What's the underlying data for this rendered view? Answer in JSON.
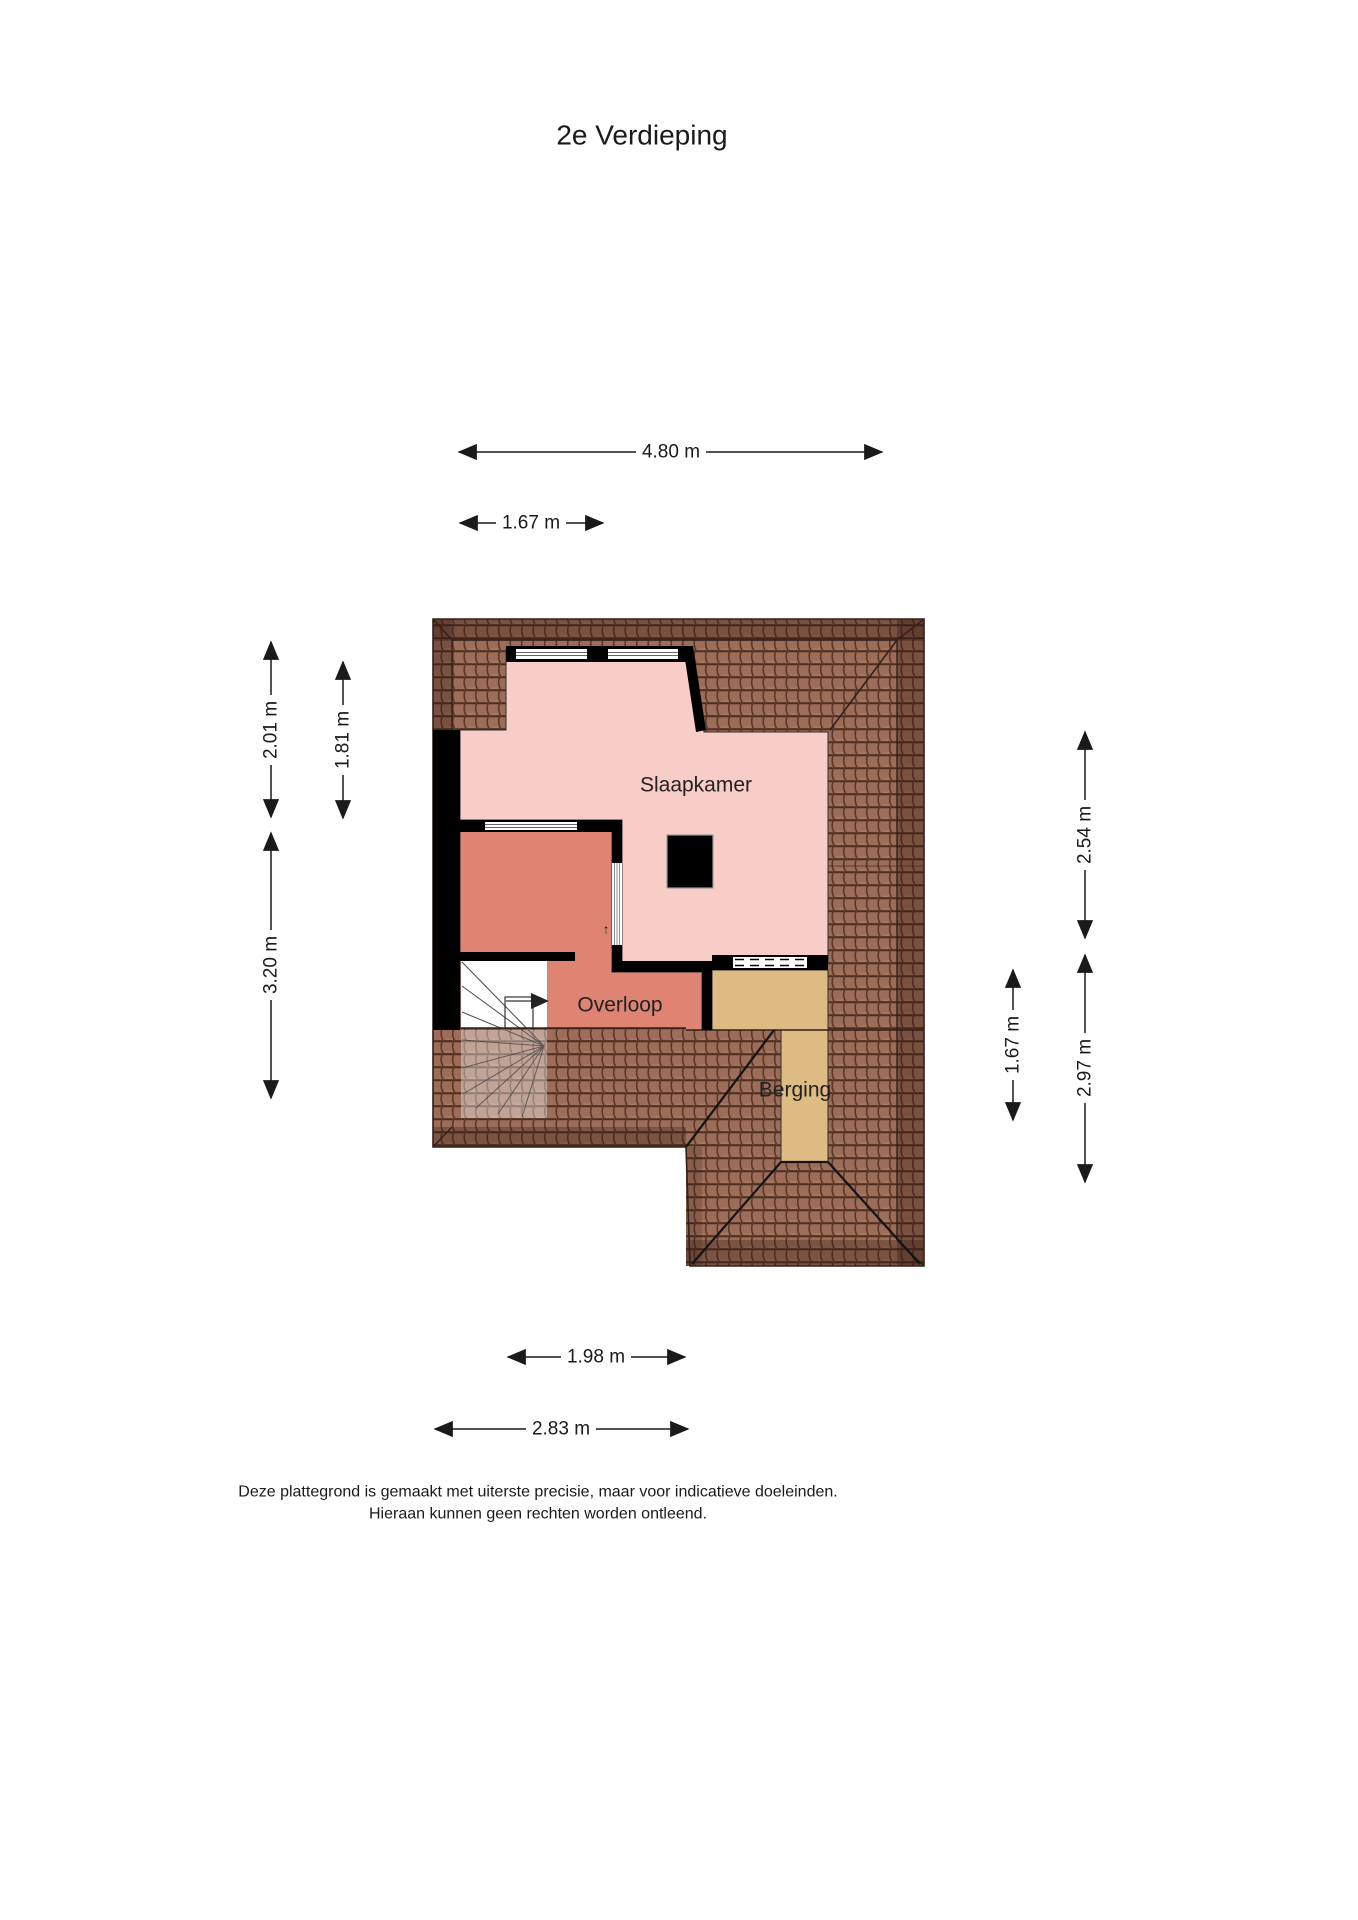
{
  "title": "2e Verdieping",
  "rooms": {
    "slaapkamer": "Slaapkamer",
    "overloop": "Overloop",
    "berging": "Berging"
  },
  "dimensions": {
    "top_width": "4.80 m",
    "top_dormer": "1.67 m",
    "left_upper": "2.01 m",
    "left_dormer": "1.81 m",
    "left_lower": "3.20 m",
    "right_upper": "2.54 m",
    "right_berging": "1.67 m",
    "right_lower": "2.97 m",
    "bottom_stairs": "1.98 m",
    "bottom_overloop": "2.83 m"
  },
  "stairs": {
    "direction_glyph": "↑"
  },
  "disclaimer": {
    "line1": "Deze plattegrond is gemaakt met uiterste precisie, maar voor indicatieve doeleinden.",
    "line2": "Hieraan kunnen geen rechten worden ontleend."
  },
  "colors": {
    "slaapkamer": "#f8cdc8",
    "overloop": "#df8473",
    "berging": "#ddbb82",
    "roof_base": "#9c6d58",
    "roof_dark": "#2e1710",
    "wall": "#000000"
  }
}
